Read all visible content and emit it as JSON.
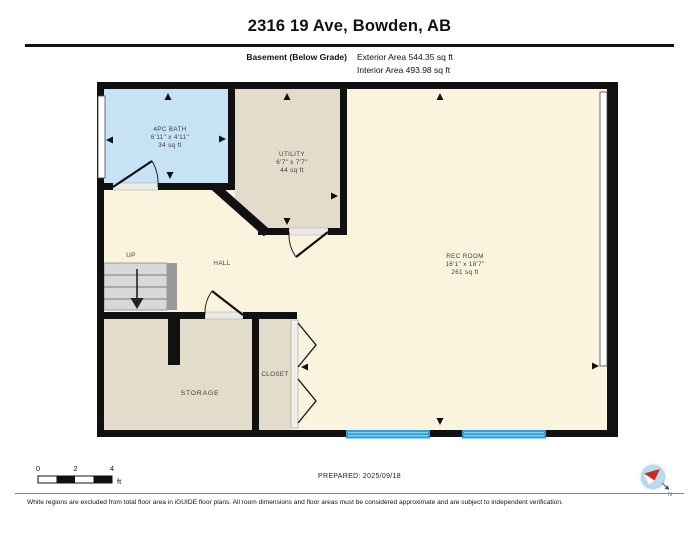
{
  "header": {
    "title": "2316 19 Ave, Bowden, AB",
    "floor_label": "Basement (Below Grade)",
    "exterior_area": "Exterior Area 544.35 sq ft",
    "interior_area": "Interior Area 493.98 sq ft"
  },
  "rooms": {
    "bath": {
      "name": "4PC BATH",
      "dims": "6'11\" x 4'11\"",
      "area": "34 sq ft"
    },
    "utility": {
      "name": "UTILITY",
      "dims": "6'7\" x 7'7\"",
      "area": "44 sq ft"
    },
    "rec": {
      "name": "REC ROOM",
      "dims": "16'1\" x 18'7\"",
      "area": "261 sq ft"
    },
    "hall": {
      "name": "HALL"
    },
    "storage": {
      "name": "STORAGE"
    },
    "closet": {
      "name": "CLOSET"
    },
    "stairs_label": "UP"
  },
  "scale_bar": {
    "ticks": [
      "0",
      "2",
      "4"
    ],
    "unit": "ft"
  },
  "prepared_label": "PREPARED: 2025/09/18",
  "compass": {
    "north_label": "N"
  },
  "footer": {
    "disclaimer": "White regions are excluded from total floor area in iGUIDE floor plans. All room dimensions and floor areas must be considered approximate and are subject to independent verification."
  },
  "colors": {
    "wall": "#111111",
    "bath_fill": "#c5e3f5",
    "tan_fill": "#e4dcca",
    "cream_fill": "#faf4df",
    "window_blue": "#2f9fd8",
    "compass_blue": "#b9dbee",
    "needle_red": "#cf2727"
  }
}
